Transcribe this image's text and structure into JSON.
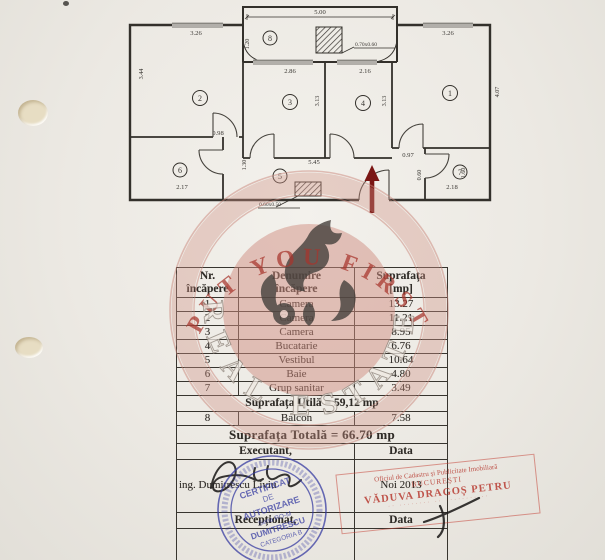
{
  "colors": {
    "paper": "#ece9e3",
    "ink": "#2c2a27",
    "entrance_arrow": "#7a1614",
    "watermark_red": "#a8352c",
    "stamp_blue": "#3136a0",
    "stamp_red": "#c43a2e"
  },
  "floor_plan": {
    "rooms": {
      "r1": "1",
      "r2": "2",
      "r3": "3",
      "r4": "4",
      "r5": "5",
      "r6": "6",
      "r7": "7",
      "r8": "8"
    },
    "dims": {
      "balcony_width": "5.00",
      "top_left_width": "3.26",
      "room3_width": "2.86",
      "room4_width": "2.16",
      "top_right_width": "3.26",
      "room2_height": "3.44",
      "room1_height": "4.07",
      "room3_height": "3.13",
      "room4_height": "3.13",
      "balcony_side": "1.20",
      "mid_left": "0.98",
      "mid_right": "0.97",
      "hall_width": "5.45",
      "hall_height": "1.30",
      "room6_width": "2.17",
      "room7_width": "2.18",
      "room7_left": "0.60",
      "room7_right": "1.60"
    },
    "shafts": {
      "top": "0.70x0.60",
      "bottom": "0.60x0.50"
    }
  },
  "watermark": {
    "top_arc": "PUT YOU FIRST",
    "bottom_arc": "REAL ESTATE"
  },
  "table": {
    "headers": {
      "col1_line1": "Nr.",
      "col1_line2": "încăpere",
      "col2_line1": "Denumire",
      "col2_line2": "încăpere",
      "col3_line1": "Suprafața",
      "col3_line2": "[mp]"
    },
    "rows": [
      {
        "nr": "1",
        "name": "Camera",
        "area": "13.27"
      },
      {
        "nr": "2",
        "name": "Camera",
        "area": "11.21"
      },
      {
        "nr": "3",
        "name": "Camera",
        "area": "8.95"
      },
      {
        "nr": "4",
        "name": "Bucatarie",
        "area": "6.76"
      },
      {
        "nr": "5",
        "name": "Vestibul",
        "area": "10.64"
      },
      {
        "nr": "6",
        "name": "Baie",
        "area": "4.80"
      },
      {
        "nr": "7",
        "name": "Grup sanitar",
        "area": "3.49"
      }
    ],
    "utila_row": "Suprafața Utilă = 59,12 mp",
    "balcon_row": {
      "nr": "8",
      "name": "Balcon",
      "area": "7.58"
    },
    "totala_row": "Suprafața Totală = 66.70 mp",
    "executant_label": "Executant,",
    "executant_data_label": "Data",
    "executant_name": "ing. Dumitrescu Liviu",
    "executant_date": "Noi 2013",
    "receptionat_label": "Recepționat,",
    "receptionat_data_label": "Data"
  },
  "stamps": {
    "certificate": {
      "l1": "CERTIFICAT",
      "l2": "DE",
      "l3": "AUTORIZARE",
      "l4": "Seria RO-M",
      "l5": "DUMITRESCU",
      "l6": "CATEGORIA B"
    },
    "cadastru": {
      "l1": "Oficiul de Cadastru și Publicitate Imobiliară",
      "l2": "BUCUREȘTI",
      "l3": "VĂDUVA DRAGOȘ PETRU",
      "l4": "·· ········ ·· ········ ··"
    }
  }
}
